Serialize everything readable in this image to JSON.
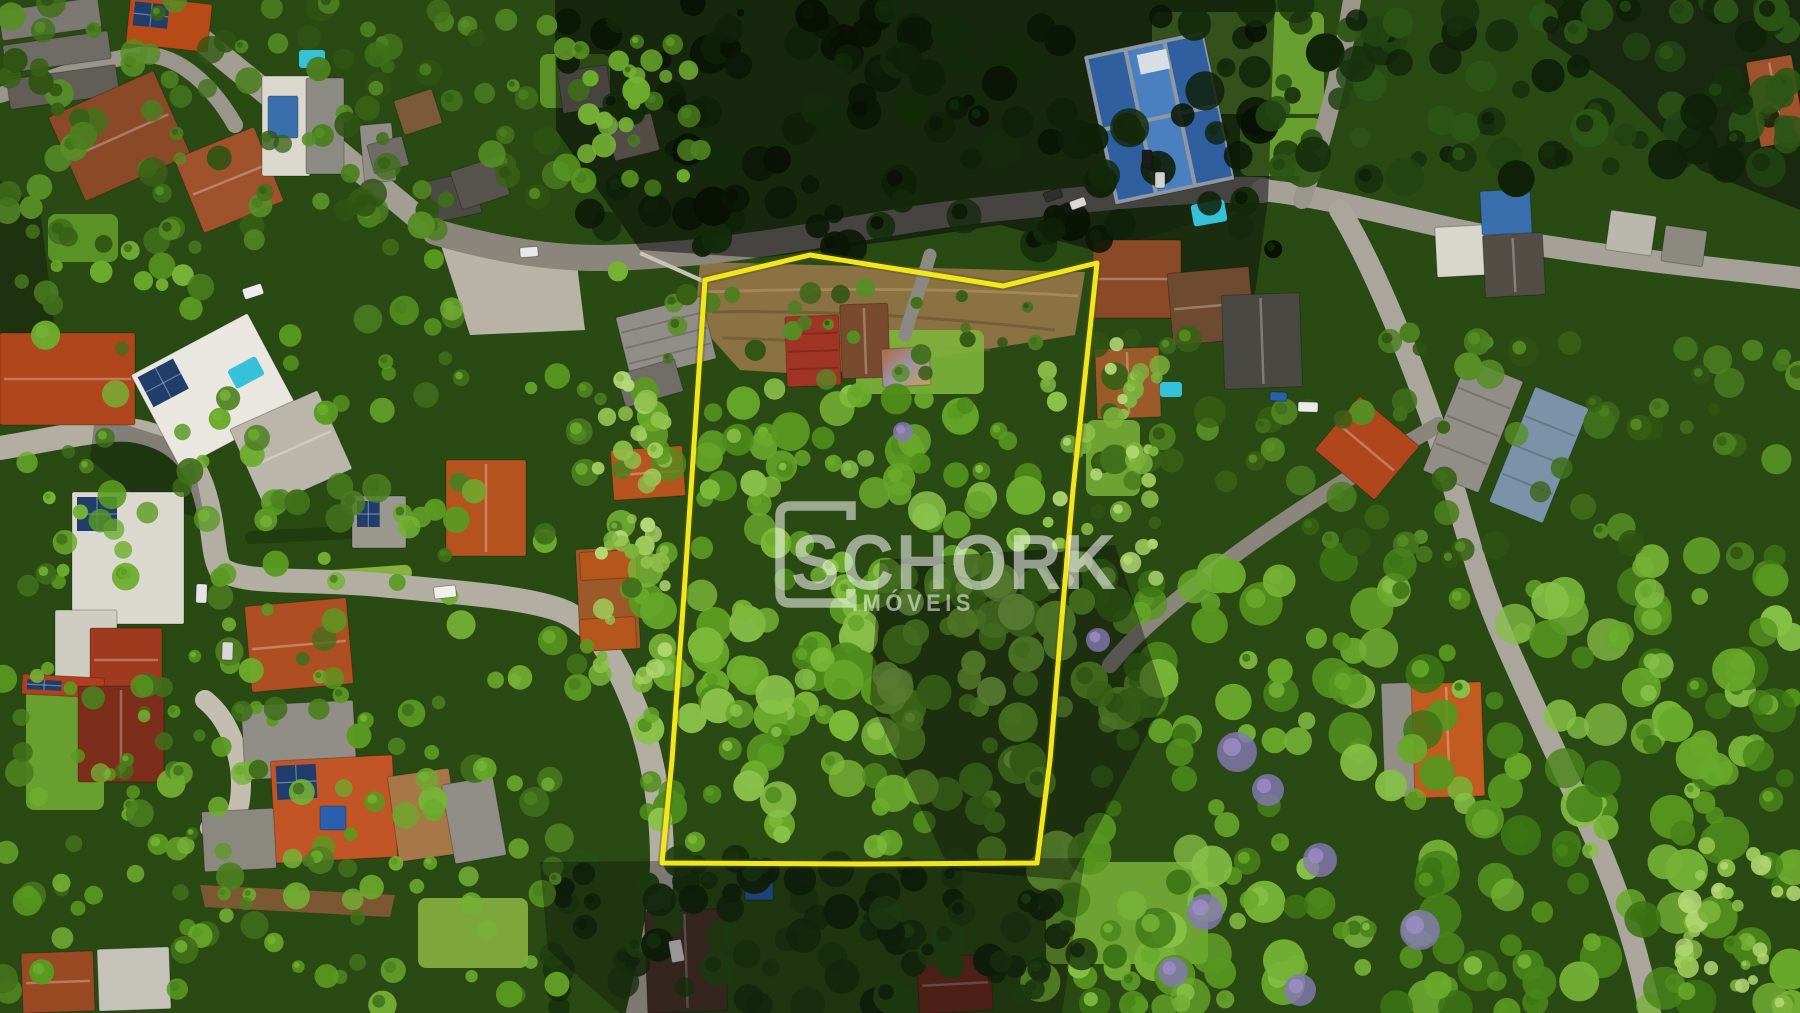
{
  "photo": {
    "kind": "aerial-drone-photograph",
    "subject": "hillside residential neighborhood with a forested land parcel outlined for sale"
  },
  "watermark": {
    "brand": "SCHORK",
    "subtitle": "IMÓVEIS",
    "color": "#ffffff",
    "opacity": 0.53
  },
  "boundary": {
    "color": "#f2e71d",
    "outline_color": "#55550a",
    "stroke_width": 5,
    "points": [
      [
        705,
        280
      ],
      [
        810,
        255
      ],
      [
        1003,
        286
      ],
      [
        1097,
        263
      ],
      [
        1073,
        490
      ],
      [
        1060,
        640
      ],
      [
        1050,
        760
      ],
      [
        1037,
        863
      ],
      [
        860,
        864
      ],
      [
        662,
        863
      ],
      [
        672,
        760
      ],
      [
        685,
        580
      ],
      [
        695,
        430
      ]
    ]
  }
}
